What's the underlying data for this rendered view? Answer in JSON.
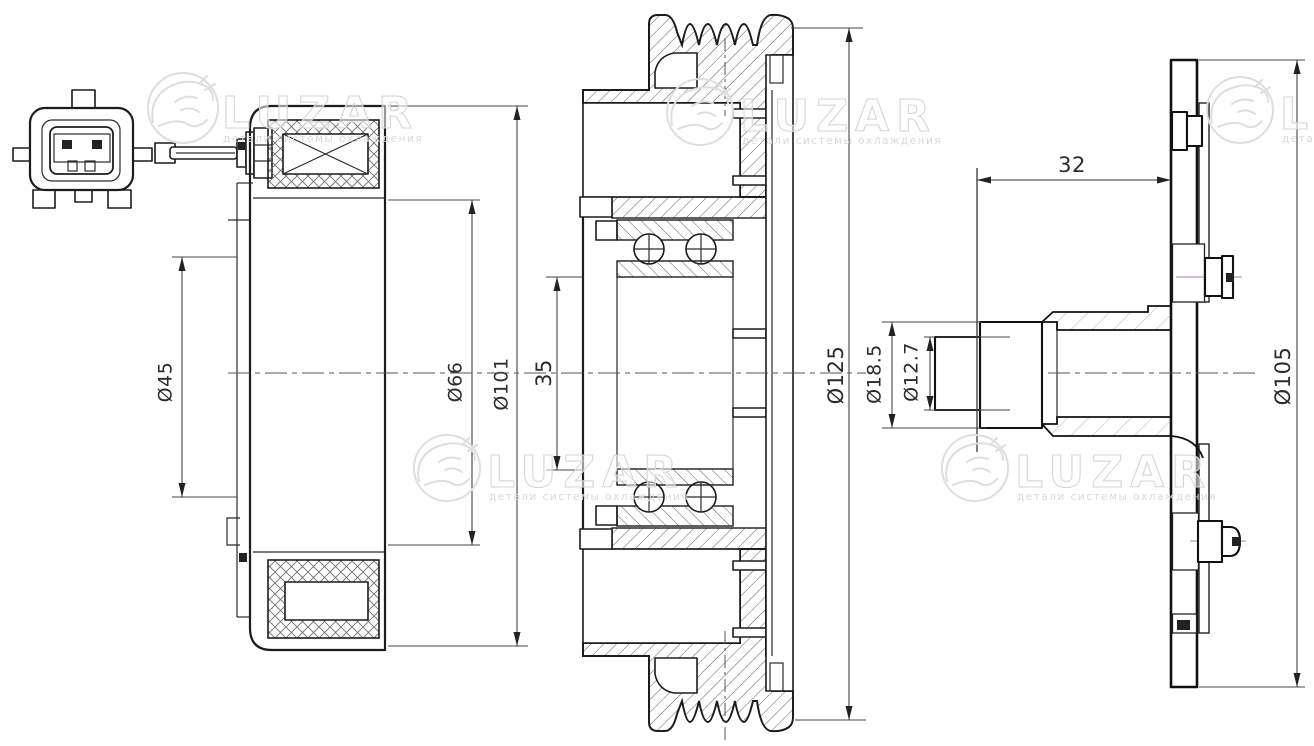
{
  "watermark": {
    "brand": "LUZAR",
    "subtitle": "детали системы охлаждения"
  },
  "dimensions": {
    "coil": {
      "d45": "Ø45",
      "d66": "Ø66",
      "d101": "Ø101"
    },
    "pulley": {
      "w35": "35",
      "d125": "Ø125"
    },
    "hub": {
      "l32": "32",
      "d185": "Ø18.5",
      "d127": "Ø12.7",
      "d105": "Ø105"
    }
  }
}
